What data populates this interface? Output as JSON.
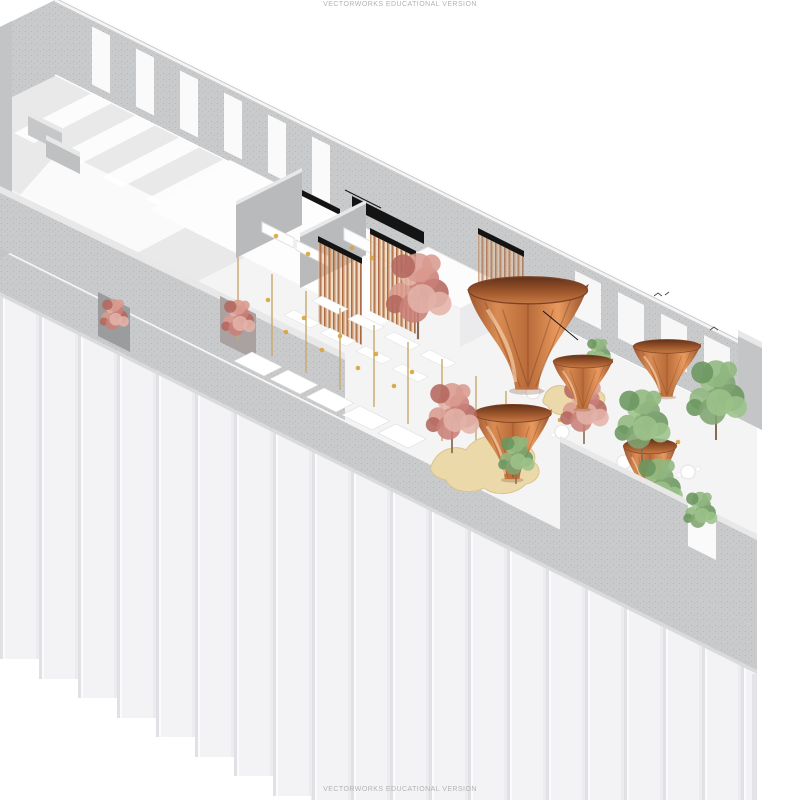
{
  "meta": {
    "description": "Axonometric cutaway rendering of a restaurant interior inside a long ribbed-panel building",
    "software_watermark": "VECTORWORKS EDUCATIONAL VERSION"
  },
  "watermark": {
    "top": "VECTORWORKS EDUCATIONAL VERSION",
    "bottom": "VECTORWORKS EDUCATIONAL VERSION"
  },
  "palette": {
    "background": "#ffffff",
    "floor": "#f4f4f5",
    "concrete": "#c9cacb",
    "concrete_dark": "#b9babb",
    "concrete_light": "#e9e9ea",
    "facade": "#f3f3f5",
    "copper": "#c87a44",
    "copper_dark": "#8a4a2b",
    "copper_light": "#e89a5e",
    "slat": "#b97a4e",
    "foliage_green": "#7fa471",
    "foliage_green_2": "#8fb77e",
    "foliage_green_3": "#6b9660",
    "foliage_green_4": "#9cc28a",
    "foliage_red": "#c98078",
    "foliage_red_2": "#d99b90",
    "foliage_red_3": "#b4685f",
    "foliage_red_4": "#e2b3a9",
    "trunk": "#8a6a4f",
    "banquette": "#ecd9a9",
    "gold": "#d9a33c",
    "pole": "#caa86b",
    "ink": "#141414",
    "watermark": "#b3b3b3"
  },
  "scene": {
    "trumpets": [
      {
        "x": 452,
        "y": 258,
        "w": 152,
        "h": 142
      },
      {
        "x": 545,
        "y": 346,
        "w": 76,
        "h": 68
      },
      {
        "x": 464,
        "y": 392,
        "w": 98,
        "h": 94
      },
      {
        "x": 624,
        "y": 330,
        "w": 86,
        "h": 72
      },
      {
        "x": 616,
        "y": 428,
        "w": 68,
        "h": 80
      }
    ],
    "trees": [
      {
        "x": 418,
        "y": 296,
        "r": 27,
        "type": "red",
        "layer": "back"
      },
      {
        "x": 584,
        "y": 412,
        "r": 20,
        "type": "red",
        "layer": "back"
      },
      {
        "x": 114,
        "y": 318,
        "r": 12,
        "type": "red",
        "layer": "back"
      },
      {
        "x": 238,
        "y": 322,
        "r": 14,
        "type": "red",
        "layer": "back"
      },
      {
        "x": 598,
        "y": 356,
        "r": 11,
        "type": "green",
        "layer": "back"
      },
      {
        "x": 452,
        "y": 418,
        "r": 22,
        "type": "red",
        "layer": "mid"
      },
      {
        "x": 716,
        "y": 400,
        "r": 25,
        "type": "green",
        "layer": "mid"
      },
      {
        "x": 642,
        "y": 426,
        "r": 23,
        "type": "green",
        "layer": "mid"
      },
      {
        "x": 658,
        "y": 490,
        "r": 20,
        "type": "green",
        "layer": "mid"
      },
      {
        "x": 516,
        "y": 460,
        "r": 15,
        "type": "green",
        "layer": "mid"
      },
      {
        "x": 700,
        "y": 514,
        "r": 14,
        "type": "green",
        "layer": "front"
      }
    ],
    "tables": [
      [
        322,
        296
      ],
      [
        358,
        314
      ],
      [
        394,
        332
      ],
      [
        430,
        350
      ],
      [
        294,
        310
      ],
      [
        330,
        328
      ],
      [
        366,
        346
      ],
      [
        402,
        364
      ]
    ],
    "booths": [
      [
        252,
        352
      ],
      [
        288,
        370
      ],
      [
        324,
        388
      ],
      [
        360,
        406
      ],
      [
        396,
        424
      ]
    ],
    "seats": [
      [
        592,
        396
      ],
      [
        562,
        432
      ],
      [
        624,
        462
      ],
      [
        688,
        472
      ],
      [
        606,
        502
      ],
      [
        533,
        392
      ]
    ],
    "poles": [
      238,
      272,
      306,
      340,
      374,
      408,
      442,
      476,
      506
    ],
    "dots": [
      [
        268,
        300
      ],
      [
        304,
        318
      ],
      [
        340,
        336
      ],
      [
        376,
        354
      ],
      [
        412,
        372
      ],
      [
        286,
        332
      ],
      [
        322,
        350
      ],
      [
        358,
        368
      ],
      [
        394,
        386
      ],
      [
        560,
        420
      ],
      [
        600,
        470
      ],
      [
        524,
        448
      ],
      [
        678,
        442
      ],
      [
        352,
        248
      ],
      [
        372,
        258
      ],
      [
        276,
        236
      ],
      [
        308,
        254
      ]
    ],
    "streaks": [
      92,
      136,
      180,
      224,
      268,
      312
    ],
    "wall_gaps": [
      92,
      136,
      180,
      224,
      268,
      312
    ],
    "windows": [
      575,
      618,
      661,
      704
    ]
  }
}
